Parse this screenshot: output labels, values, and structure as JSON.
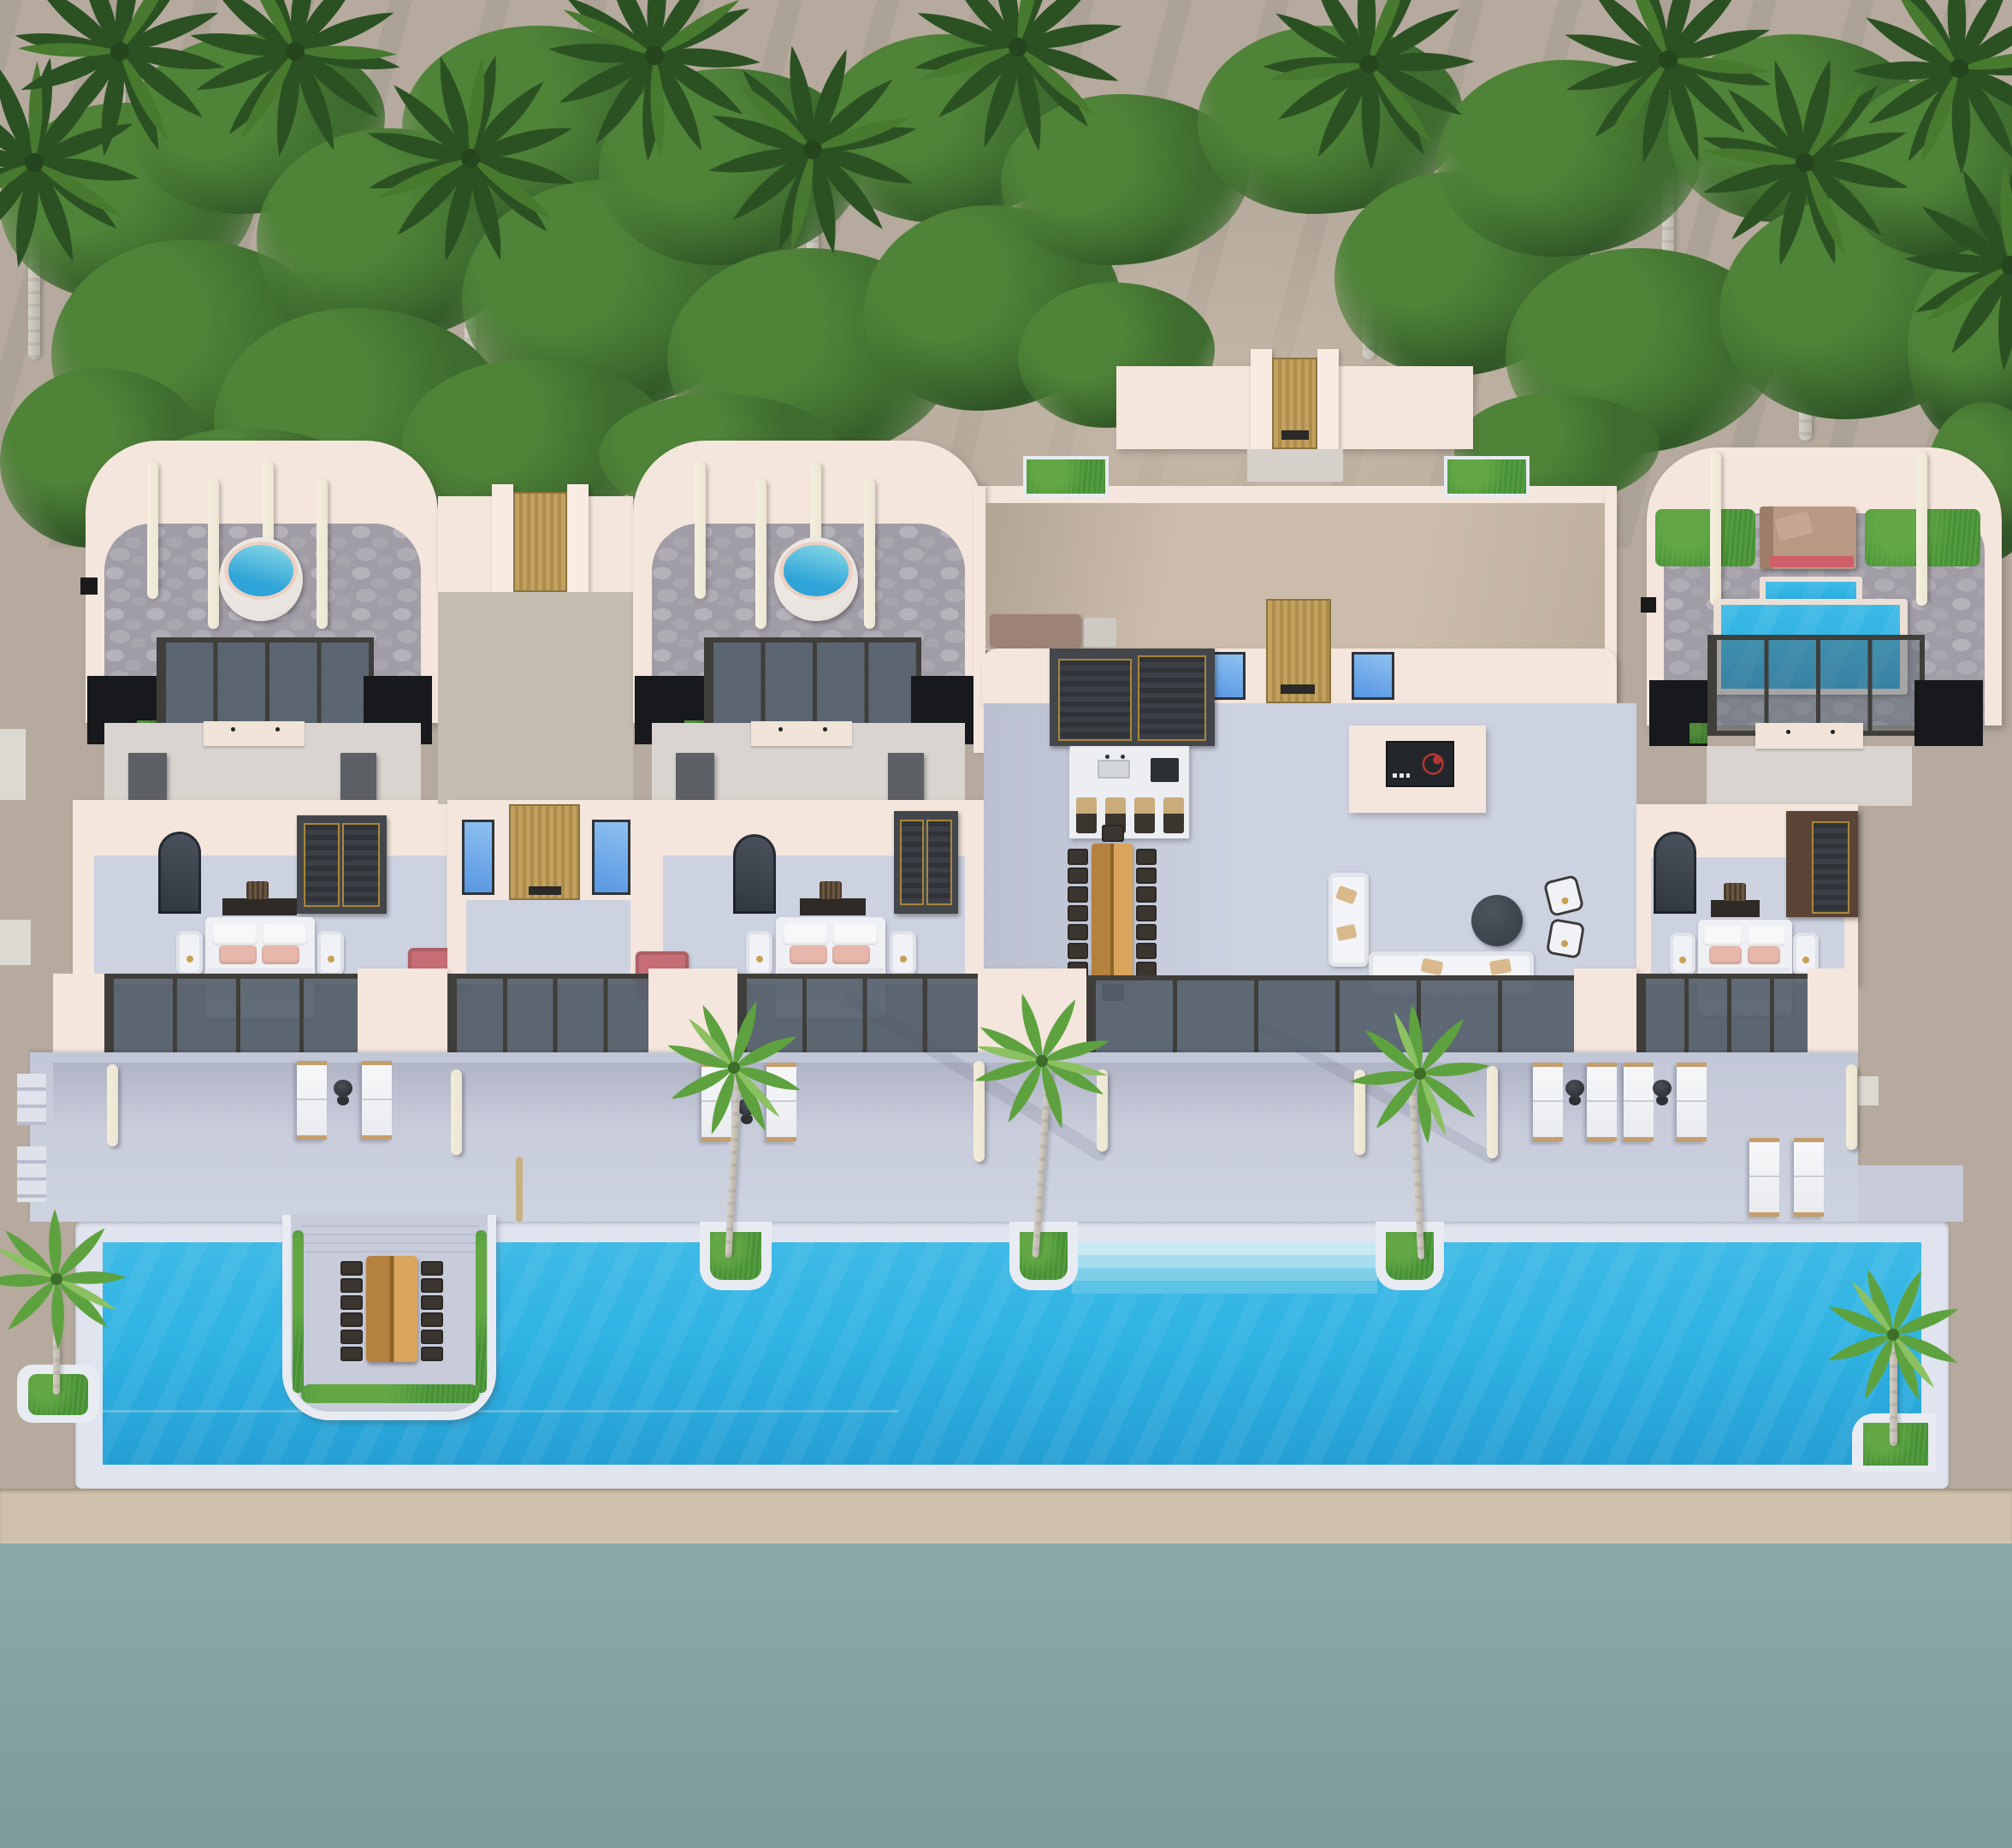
{
  "scene": {
    "title": "aerial-3d-render-beachfront-villa-resort",
    "view": "top-down axonometric architectural visualization, roofless cutaway",
    "regions": [
      "palm-grove",
      "three-guest-suites",
      "central-courtyard",
      "open-living-kitchen",
      "sun-deck",
      "infinity-pool",
      "beach",
      "ocean"
    ]
  },
  "inventory": {
    "suites": 3,
    "circular-jacuzzis": 2,
    "rooftop-plunge-pool": 1,
    "main-pool": 1,
    "sunken-dining-table-seats": 12,
    "indoor-dining-side-chairs": 14,
    "bar-stools": 4,
    "sun-loungers": 10,
    "pool-palm-planters": 3,
    "corner-palm-planters": 2,
    "beds": 3,
    "entry-gates-wood": 4,
    "blue-skylight-windows": 6
  },
  "palette": {
    "sand": "#b5aa9d",
    "sand-dk": "#a79d90",
    "path": "#cbbcab",
    "beach": "#cfc1ac",
    "ocean": "#8aa9a7",
    "ocean-dk": "#7c9d9b",
    "deck": "#c7cbda",
    "deck-dk": "#aeb3c6",
    "coping": "#e0e4ee",
    "curb": "#e8ebf2",
    "pool": "#2fb3e3",
    "pool-dk": "#259fd4",
    "step1": "#c9e9f3",
    "step2": "#a6ddef",
    "step3": "#7fcfe9",
    "step4": "#5cc2e6",
    "wall": "#f4e6dc",
    "wall-sh": "#e5d2c7",
    "wall-dk": "#d9c5ba",
    "cob": "#a19da6",
    "cob-lt": "#b6b2ba",
    "mroom": "#d9d4cf",
    "intfloor": "#cdd2e1",
    "dkfloor": "#17191c",
    "frame": "#3f3e3a",
    "glass": "#67717d",
    "wood": "#c2a05e",
    "wood-dk": "#ad8c4c",
    "bwin1": "#8fc1f0",
    "bwin2": "#5796e2",
    "grass": "#479234",
    "grass-lt": "#63a845",
    "bush1": "#2f5526",
    "bush2": "#3e6c2f",
    "bush3": "#4f8338",
    "bush4": "#61984a",
    "palm1": "#2b5123",
    "palm2": "#3a682c",
    "palm3": "#47792f",
    "palmS1": "#5ea23f",
    "palmS2": "#76b352",
    "trunk": "#d6d2c9",
    "trunk-dk": "#b9b3a8",
    "jrim": "#e9e4df",
    "jring": "#ecd0c2",
    "jwater1": "#8edbe6",
    "jwater2": "#2ea4d8",
    "bed": "#eef0f4",
    "pillow": "#f7f8fa",
    "pink": "#e7b7ab",
    "chaise": "#c66d75",
    "daybed": "#b99884",
    "dayred": "#d05f6b",
    "ottoman": "#3d434c",
    "twood": "#b5813f",
    "twood-lt": "#d9a55c",
    "chair": "#3a352f",
    "marble": "#eceef2",
    "cab": "#43464b",
    "gold": "#a8863c",
    "brown": "#5a4436",
    "mauve": "#9d8278",
    "tv": "#23262b",
    "tvred": "#c23a33",
    "cream": "#f0e4d8",
    "lounger": "#f4f5f7",
    "ltrim": "#c49e6b",
    "bollard": "#ece5d2",
    "pad": "#dcd8d2"
  }
}
